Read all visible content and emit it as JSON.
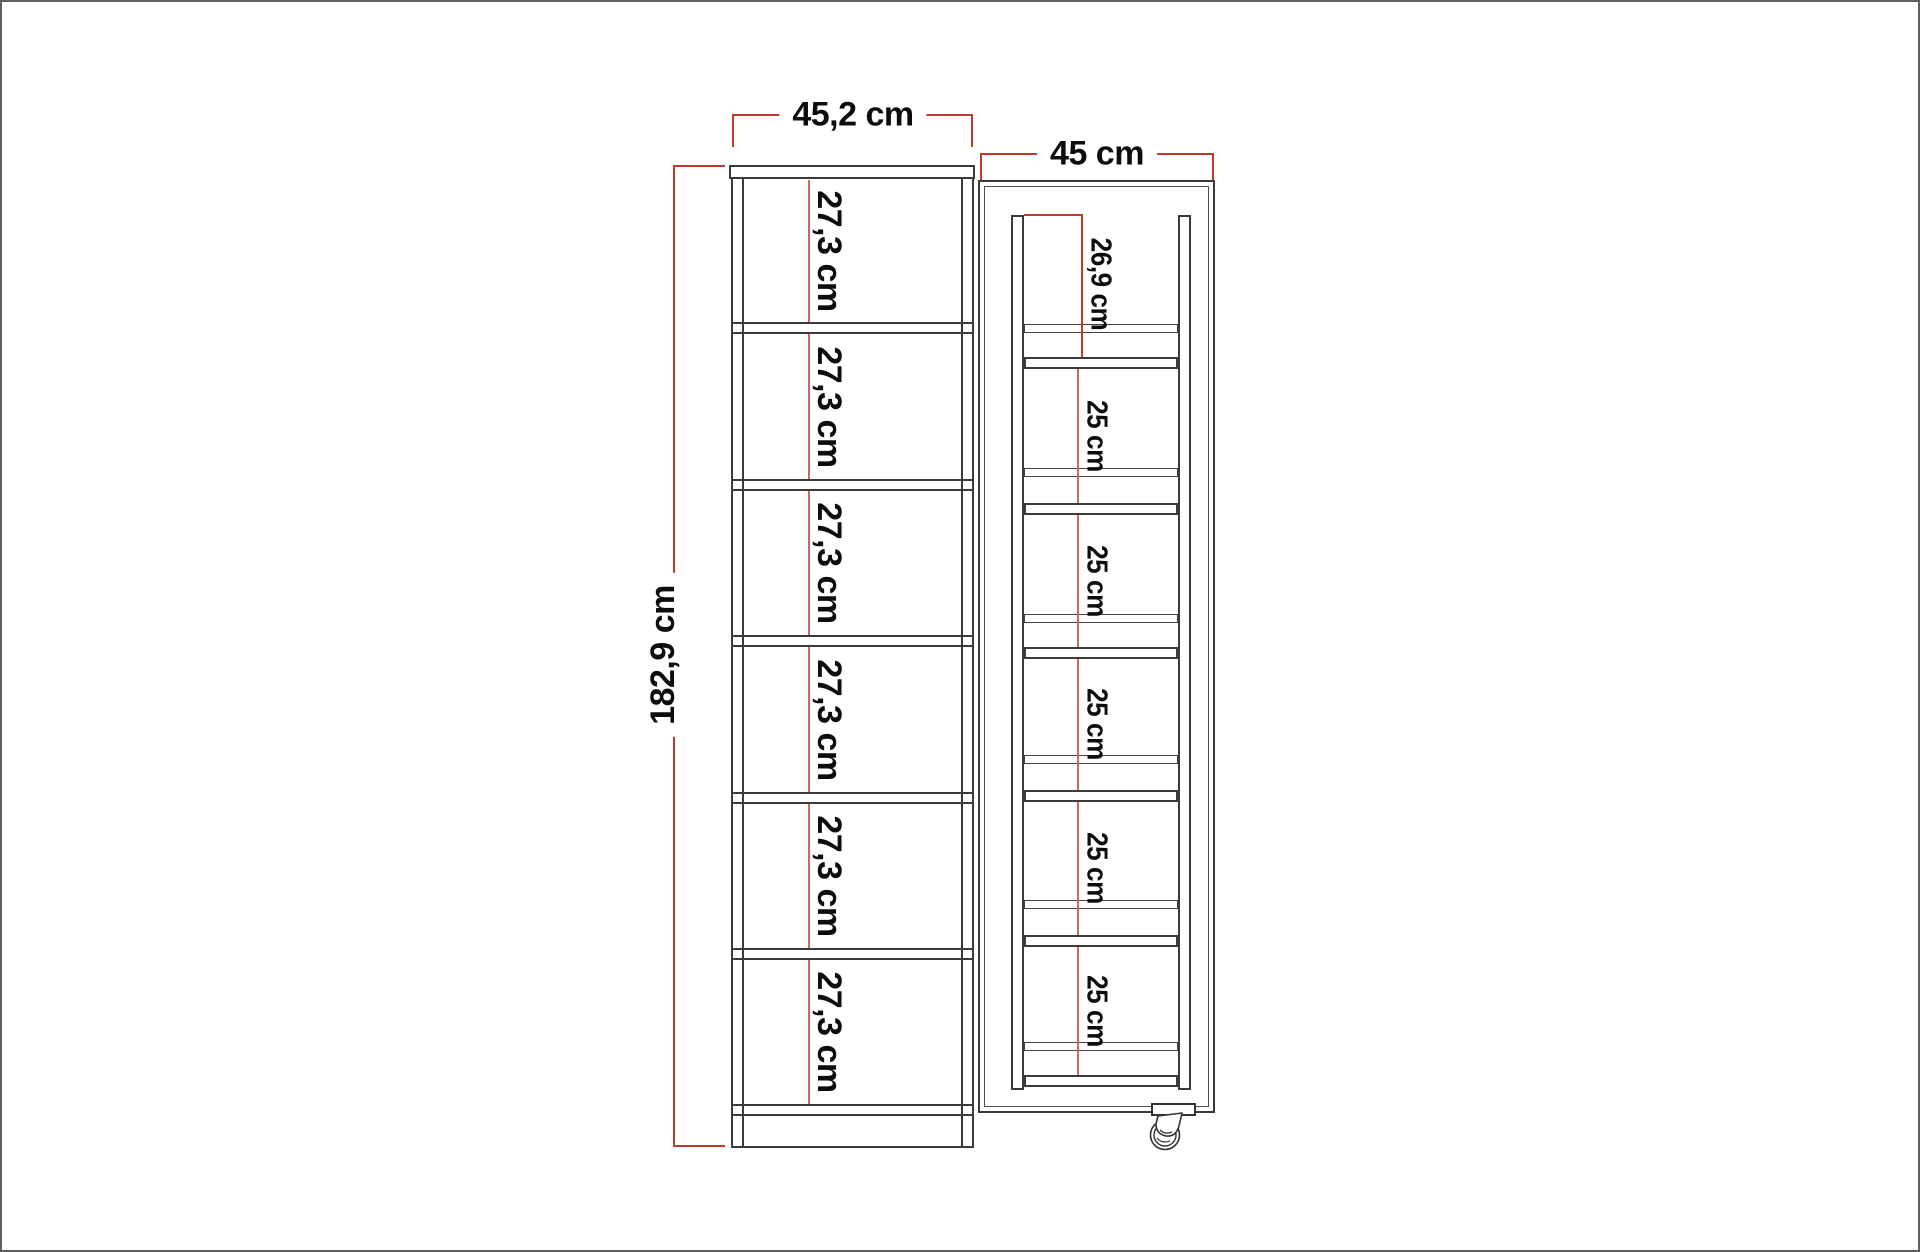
{
  "drawing": {
    "front_view": {
      "width_label": "45,2 cm",
      "height_label": "182,9 cm",
      "shelf_labels": [
        "27,3 cm",
        "27,3 cm",
        "27,3 cm",
        "27,3 cm",
        "27,3 cm",
        "27,3 cm"
      ]
    },
    "side_view": {
      "width_label": "45 cm",
      "section_labels": [
        "26,9 cm",
        "25 cm",
        "25 cm",
        "25 cm",
        "25 cm",
        "25 cm"
      ]
    },
    "colors": {
      "dimension_red": "#c0392b",
      "interior_red": "#c25a4a",
      "outline_dark": "#3b3b3b"
    }
  }
}
